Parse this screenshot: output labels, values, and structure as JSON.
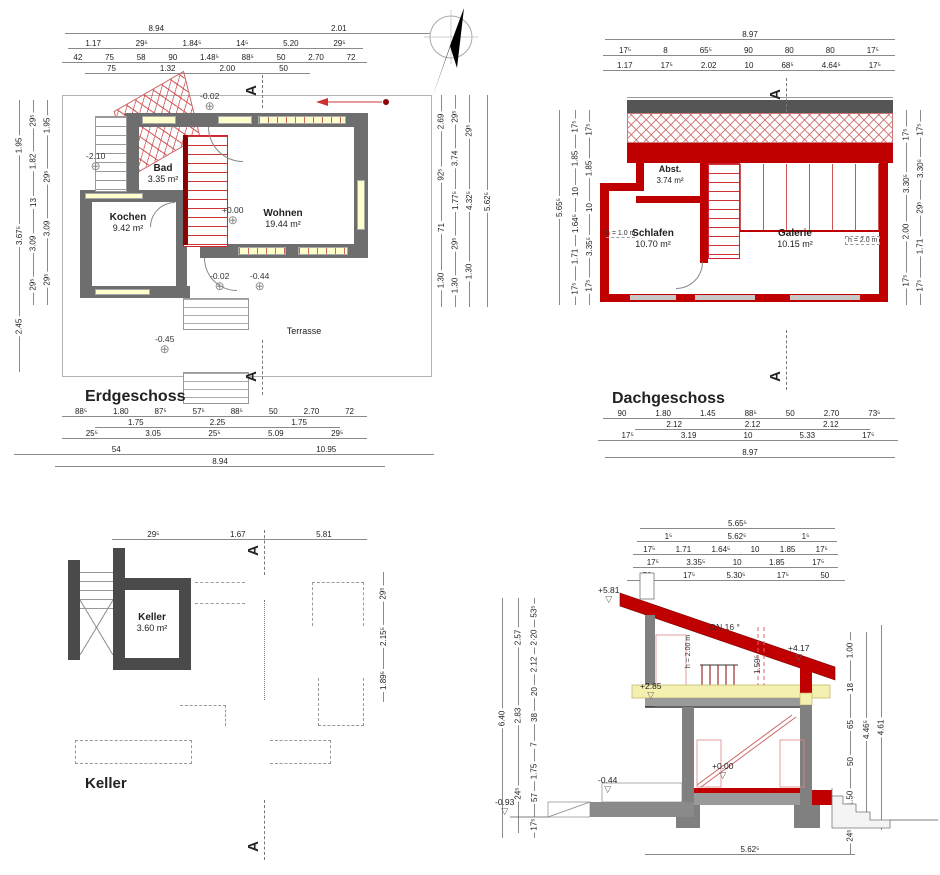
{
  "section_letter": "A",
  "icons": {
    "north_letter": "N",
    "elevation_marker": "⊕",
    "level_marker": "▽"
  },
  "colors": {
    "wall_gray": "#6e6e6e",
    "wall_red": "#c00000",
    "window_yellow": "#ffffcc"
  },
  "erdgeschoss": {
    "title": "Erdgeschoss",
    "rooms": {
      "bad": {
        "name": "Bad",
        "area": "3.35 m²"
      },
      "kochen": {
        "name": "Kochen",
        "area": "9.42 m²"
      },
      "wohnen": {
        "name": "Wohnen",
        "area": "19.44 m²"
      },
      "terrasse": {
        "name": "Terrasse"
      }
    },
    "levels": {
      "top": "-0.02",
      "basement": "-2.10",
      "main": "+0.00",
      "door": "-0.02",
      "terrace_door": "-0.44",
      "terrace": "-0.45"
    },
    "dims": {
      "t1": [
        "8.94",
        "2.01"
      ],
      "t2": [
        "1.17",
        "29⁵",
        "1.84⁵",
        "14⁵",
        "5.20",
        "29⁵"
      ],
      "t3": [
        "42",
        "75",
        "58",
        "90",
        "1.48⁵",
        "88⁵",
        "50",
        "2.70",
        "72"
      ],
      "t4": [
        "75",
        "1.32",
        "2.00",
        "50"
      ],
      "b1": [
        "88⁵",
        "1.80",
        "87⁵",
        "57⁵",
        "88⁵",
        "50",
        "2.70",
        "72"
      ],
      "b2": [
        "1.75",
        "2.25",
        "1.75"
      ],
      "b3": [
        "25⁵",
        "3.05",
        "25⁵",
        "5.09",
        "29⁵"
      ],
      "b4": [
        "54",
        "10.95"
      ],
      "b5": [
        "8.94"
      ],
      "l1": [
        "1.95",
        "3.67⁵",
        "2.45"
      ],
      "l2": [
        "29⁵",
        "1.82",
        "13",
        "3.09",
        "29⁵"
      ],
      "l3": [
        "1.95",
        "29⁵",
        "3.09",
        "29⁵"
      ],
      "r1": [
        "2.69",
        "92⁵",
        "71",
        "1.30"
      ],
      "r2": [
        "29⁵",
        "3.74",
        "1.77⁵",
        "29⁵",
        "1.30"
      ],
      "r3": [
        "29⁵",
        "4.32⁵",
        "1.30"
      ],
      "r4": [
        "5.62⁵"
      ]
    }
  },
  "dachgeschoss": {
    "title": "Dachgeschoss",
    "rooms": {
      "abst": {
        "name": "Abst.",
        "area": "3.74 m²"
      },
      "schlafen": {
        "name": "Schlafen",
        "area": "10.70 m²"
      },
      "galerie": {
        "name": "Galerie",
        "area": "10.15 m²"
      }
    },
    "notes": {
      "left": "h = 1.0 m",
      "right": "h = 2.0 m"
    },
    "dims": {
      "t1": [
        "8.97"
      ],
      "t2": [
        "17⁵",
        "8",
        "65⁵",
        "90",
        "80",
        "80",
        "17⁵"
      ],
      "t3": [
        "1.17",
        "17⁵",
        "2.02",
        "10",
        "68⁵",
        "4.64⁵",
        "17⁵"
      ],
      "b1": [
        "90",
        "1.80",
        "1.45",
        "88⁵",
        "50",
        "2.70",
        "73⁵"
      ],
      "b2": [
        "2.12",
        "2.12",
        "2.12"
      ],
      "b3": [
        "17⁵",
        "3.19",
        "10",
        "5.33",
        "17⁵"
      ],
      "b4": [
        "8.97"
      ],
      "l1": [
        "5.65⁵"
      ],
      "l2": [
        "17⁵",
        "1.85",
        "10",
        "1.64⁵",
        "1.71",
        "17⁵"
      ],
      "l3": [
        "17⁵",
        "1.85",
        "10",
        "3.35⁵",
        "17⁵"
      ],
      "r1": [
        "17⁵",
        "3.30⁵",
        "2.00",
        "17⁵"
      ],
      "r2": [
        "17⁵",
        "3.30⁵",
        "29⁵",
        "1.71",
        "17⁵"
      ]
    }
  },
  "keller": {
    "title": "Keller",
    "room": {
      "name": "Keller",
      "area": "3.60 m²"
    },
    "dims": {
      "t1": [
        "29⁵",
        "1.67",
        "5.81"
      ],
      "r1": [
        "29⁵",
        "2.15⁵",
        "1.89⁵"
      ]
    }
  },
  "schnitt": {
    "labels": {
      "peak": "+5.81",
      "slope": "DN 16 °",
      "eave": "+4.17",
      "height_note": "h = 2.00 m",
      "rail": "1.59⁵",
      "upper": "+2.85",
      "ground": "+0.00",
      "terrace": "-0.44",
      "bottom": "-0.93"
    },
    "dims": {
      "t1": [
        "5.65⁵"
      ],
      "t2": [
        "1⁵",
        "5.62⁵",
        "1⁵"
      ],
      "t3": [
        "17⁵",
        "1.71",
        "1.64⁵",
        "10",
        "1.85",
        "17⁵"
      ],
      "t4": [
        "17⁵",
        "3.35⁵",
        "10",
        "1.85",
        "17⁵"
      ],
      "t5": [
        "50",
        "17⁵",
        "5.30⁵",
        "17⁵",
        "50"
      ],
      "b1": [
        "5.62⁵"
      ],
      "l1": [
        "6.40"
      ],
      "l2": [
        "2.57",
        "2.83",
        "24⁵"
      ],
      "l3": [
        "53⁵",
        "2·20",
        "2.12",
        "20",
        "38",
        "7",
        "1.75",
        "57",
        "17⁵"
      ],
      "r1": [
        "1.00",
        "18",
        "65",
        "50",
        "1.50",
        "24⁵"
      ],
      "r2": [
        "4.46⁵"
      ],
      "r3": [
        "4.61"
      ]
    }
  }
}
